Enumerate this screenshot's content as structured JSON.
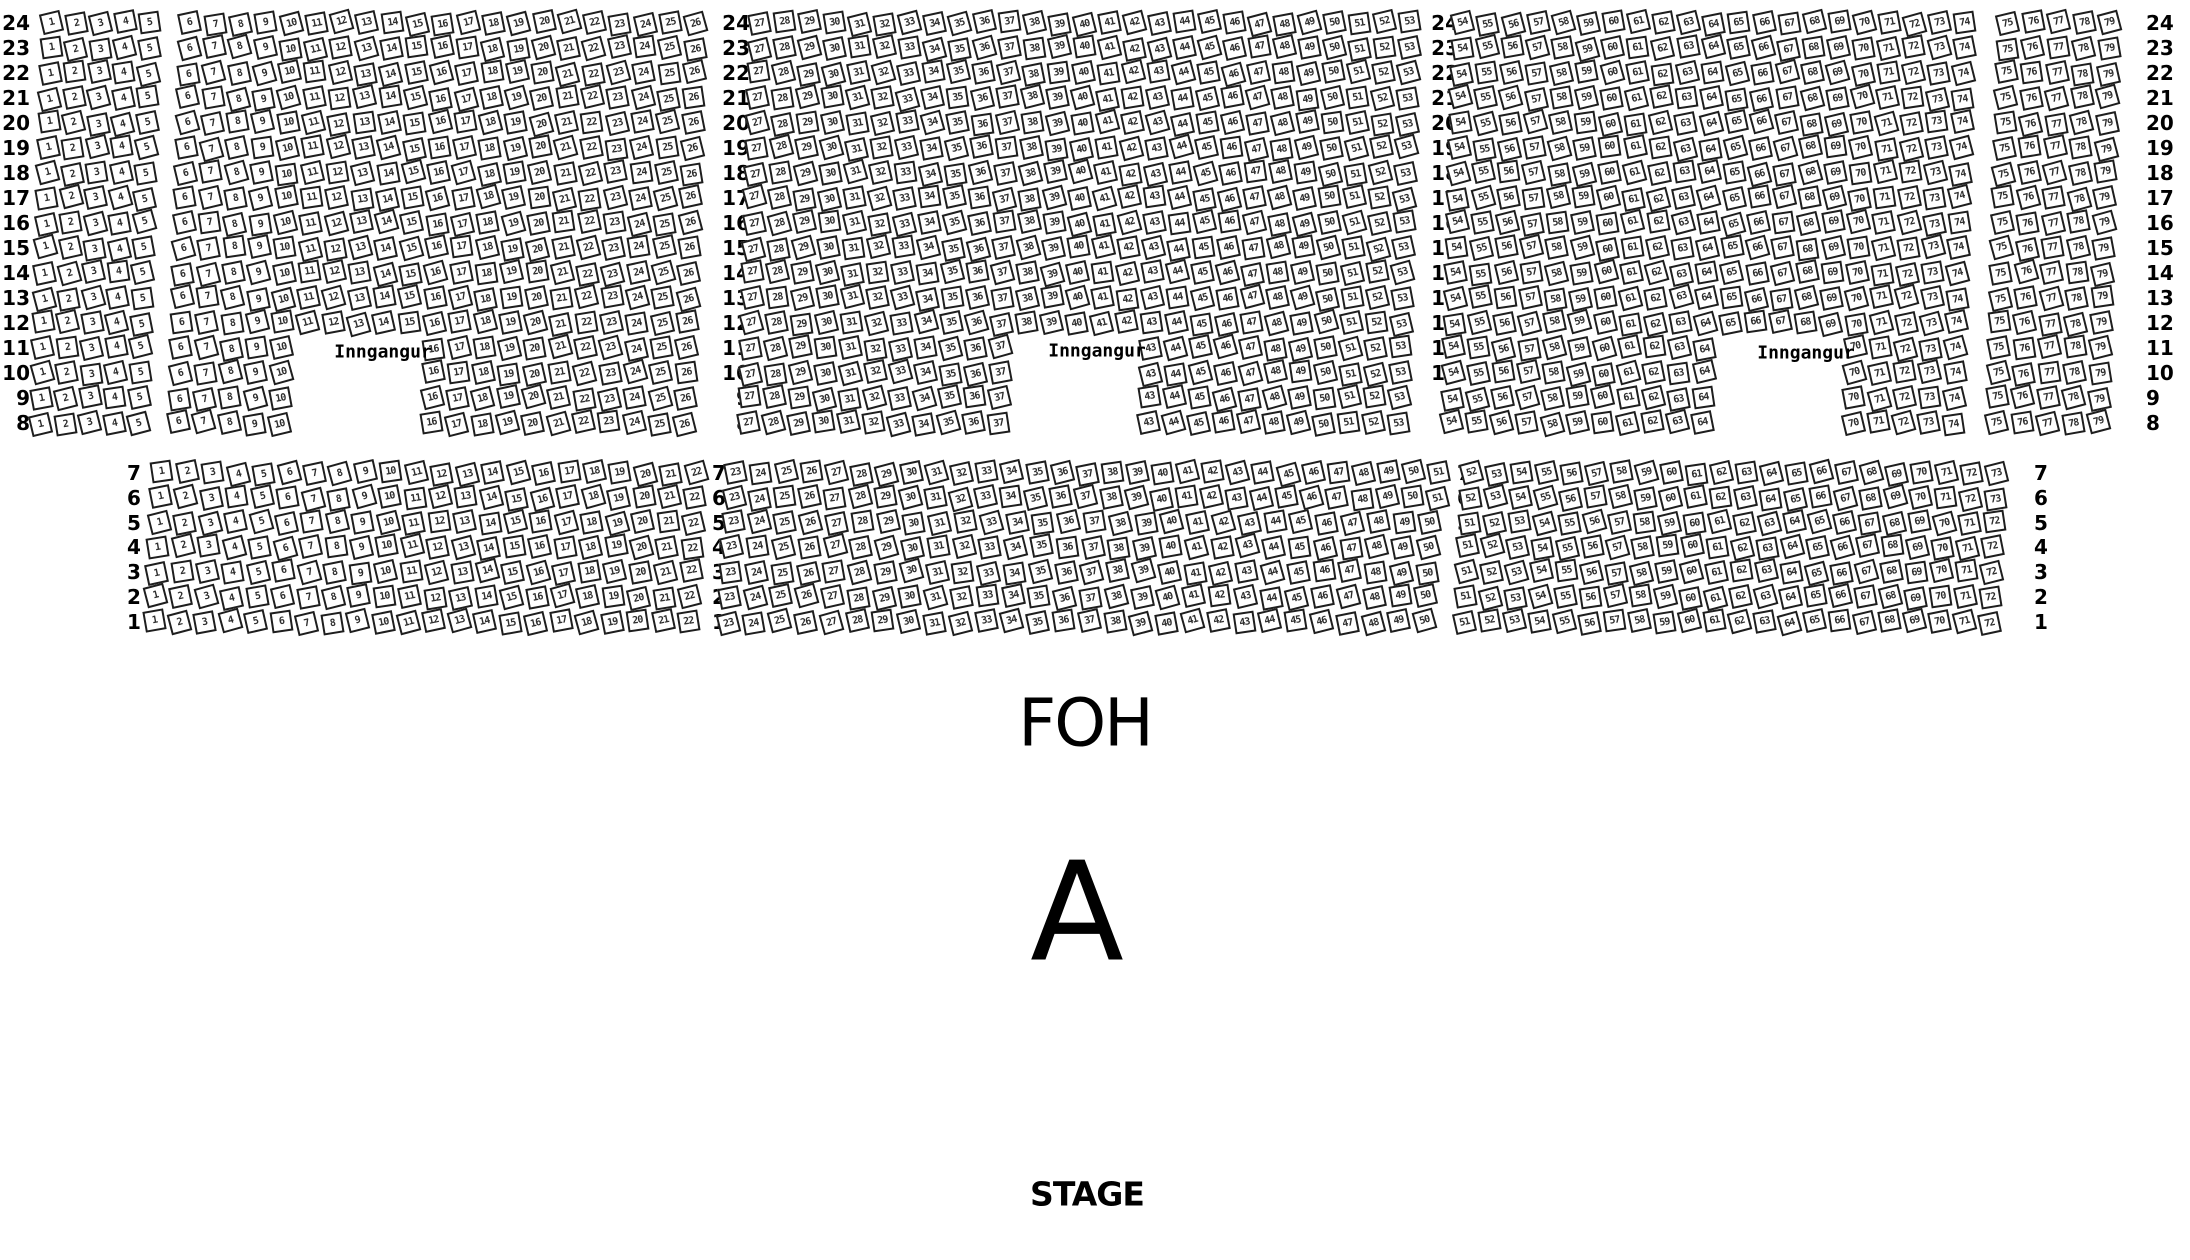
{
  "canvas": {
    "width": 2190,
    "height": 1260,
    "background": "#ffffff"
  },
  "labels": {
    "foh": "FOH",
    "section": "A",
    "stage": "STAGE",
    "entrance": "Inngangur"
  },
  "style": {
    "seat_fill": "#ffffff",
    "seat_border": "#1e1e1e",
    "seat_number_color": "#2e2e2e",
    "label_color": "#000000",
    "seat_base_rotation_deg": -12
  },
  "entrances": [
    {
      "x": 383,
      "y": 352
    },
    {
      "x": 1097,
      "y": 351
    },
    {
      "x": 1806,
      "y": 353
    }
  ],
  "sections": [
    {
      "name": "rear-section-rows-24-8",
      "y_top": 23,
      "row_spacing": 25,
      "row_drift": -0.7,
      "rows": [
        24,
        23,
        22,
        21,
        20,
        19,
        18,
        17,
        16,
        15,
        14,
        13,
        12,
        11,
        10,
        9,
        8
      ],
      "label_columns": [
        {
          "x": 30,
          "align": "right"
        },
        {
          "x": 750,
          "align": "right"
        },
        {
          "x": 1459,
          "align": "right"
        },
        {
          "x": 2146,
          "align": "left"
        }
      ],
      "blocks": [
        {
          "x": 52,
          "spacing": 24.5,
          "row_specs": [
            {
              "rows": [
                24,
                23,
                22,
                21,
                20,
                19,
                18,
                17,
                16,
                15,
                14,
                13,
                12,
                11,
                10,
                9,
                8
              ],
              "col0_seat": 1,
              "segments": [
                [
                  1,
                  5
                ]
              ]
            }
          ]
        },
        {
          "x": 190,
          "spacing": 25.3,
          "row_specs": [
            {
              "rows": [
                24,
                23,
                22,
                21,
                20,
                19,
                18,
                17,
                16,
                15,
                14,
                13,
                12
              ],
              "col0_seat": 6,
              "segments": [
                [
                  6,
                  26
                ]
              ]
            },
            {
              "rows": [
                11,
                10,
                9,
                8
              ],
              "col0_seat": 6,
              "segments": [
                [
                  6,
                  10
                ],
                [
                  16,
                  26
                ]
              ]
            }
          ]
        },
        {
          "x": 760,
          "spacing": 25.0,
          "row_specs": [
            {
              "rows": [
                24,
                23,
                22,
                21,
                20,
                19,
                18,
                17,
                16,
                15,
                14,
                13,
                12
              ],
              "col0_seat": 27,
              "segments": [
                [
                  27,
                  53
                ]
              ]
            },
            {
              "rows": [
                11,
                10,
                9,
                8
              ],
              "col0_seat": 27,
              "segments": [
                [
                  27,
                  37
                ],
                [
                  43,
                  53
                ]
              ]
            }
          ]
        },
        {
          "x": 1463,
          "spacing": 25.1,
          "row_specs": [
            {
              "rows": [
                24,
                23,
                22,
                21,
                20,
                19,
                18,
                17,
                16,
                15,
                14,
                13,
                12
              ],
              "col0_seat": 54,
              "segments": [
                [
                  54,
                  74
                ]
              ]
            },
            {
              "rows": [
                11,
                10,
                9,
                8
              ],
              "col0_seat": 54,
              "segments": [
                [
                  54,
                  64
                ],
                [
                  70,
                  74
                ]
              ]
            }
          ]
        },
        {
          "x": 2008,
          "spacing": 25.5,
          "row_specs": [
            {
              "rows": [
                24,
                23,
                22,
                21,
                20,
                19,
                18,
                17,
                16,
                15,
                14,
                13,
                12,
                11,
                10,
                9,
                8
              ],
              "col0_seat": 75,
              "segments": [
                [
                  75,
                  79
                ]
              ]
            }
          ]
        }
      ]
    },
    {
      "name": "front-section-rows-7-1",
      "y_top": 473,
      "row_spacing": 24.8,
      "row_drift": -1.3,
      "rows": [
        7,
        6,
        5,
        4,
        3,
        2,
        1
      ],
      "label_columns": [
        {
          "x": 134,
          "align": "center"
        },
        {
          "x": 719,
          "align": "center"
        },
        {
          "x": 1464,
          "align": "center"
        },
        {
          "x": 2041,
          "align": "center"
        }
      ],
      "blocks": [
        {
          "x": 162,
          "spacing": 25.45,
          "row_specs": [
            {
              "rows": [
                7,
                6,
                5,
                4,
                3,
                2,
                1
              ],
              "col0_seat": 1,
              "segments": [
                [
                  1,
                  22
                ]
              ]
            }
          ]
        },
        {
          "x": 736,
          "spacing": 25.1,
          "row_specs": [
            {
              "rows": [
                7,
                6
              ],
              "col0_seat": 23,
              "segments": [
                [
                  23,
                  51
                ]
              ]
            },
            {
              "rows": [
                5,
                4,
                3,
                2,
                1
              ],
              "col0_seat": 23,
              "spacing": 25.8,
              "segments": [
                [
                  23,
                  50
                ]
              ]
            }
          ]
        },
        {
          "x": 1472,
          "spacing": 25.0,
          "row_specs": [
            {
              "rows": [
                7,
                6
              ],
              "col0_seat": 52,
              "segments": [
                [
                  52,
                  73
                ]
              ]
            },
            {
              "rows": [
                5,
                4,
                3,
                2,
                1
              ],
              "col0_seat": 51,
              "segments": [
                [
                  51,
                  72
                ]
              ]
            }
          ]
        }
      ]
    }
  ]
}
